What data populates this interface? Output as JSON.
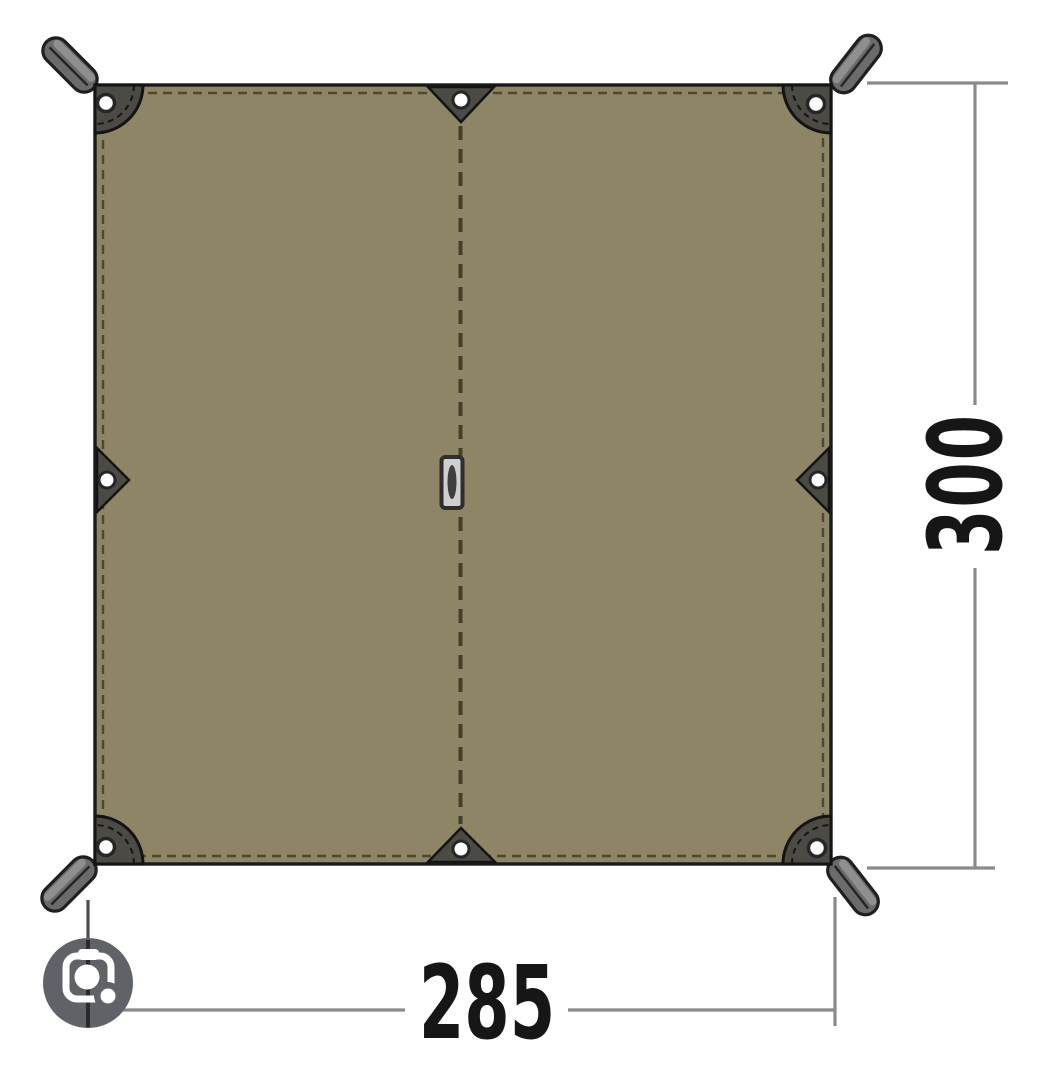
{
  "diagram": {
    "type": "tarp-dimension-drawing",
    "width_label": "285",
    "height_label": "300",
    "dimensions": {
      "width": 285,
      "height": 300
    },
    "features": {
      "corner_straps": 4,
      "corner_reinforcement_patches": 4,
      "corner_grommets": 4,
      "edge_tieout_triangles": 4,
      "edge_tieout_grommets": 4,
      "center_hang_loop": 1,
      "center_seam": "vertical dashed stitch line"
    }
  },
  "ui": {
    "lens_button": {
      "icon": "camera-lens-icon"
    }
  },
  "colors": {
    "background": "#ffffff",
    "fabric": "#8d8566",
    "outline": "#1a1a1a",
    "stitch": "#4f4731",
    "patch": "#4b4a45",
    "strap": "#6b6b6b",
    "strap_highlight": "#949494",
    "grommet_fill": "#ffffff",
    "grommet_ring": "#262626",
    "dimension_line": "#8a8a8a",
    "extension_line_dark": "#4d4d4d",
    "dimension_text": "#161616",
    "lens_button_bg": "#5f6368",
    "lens_glyph": "#ffffff"
  }
}
